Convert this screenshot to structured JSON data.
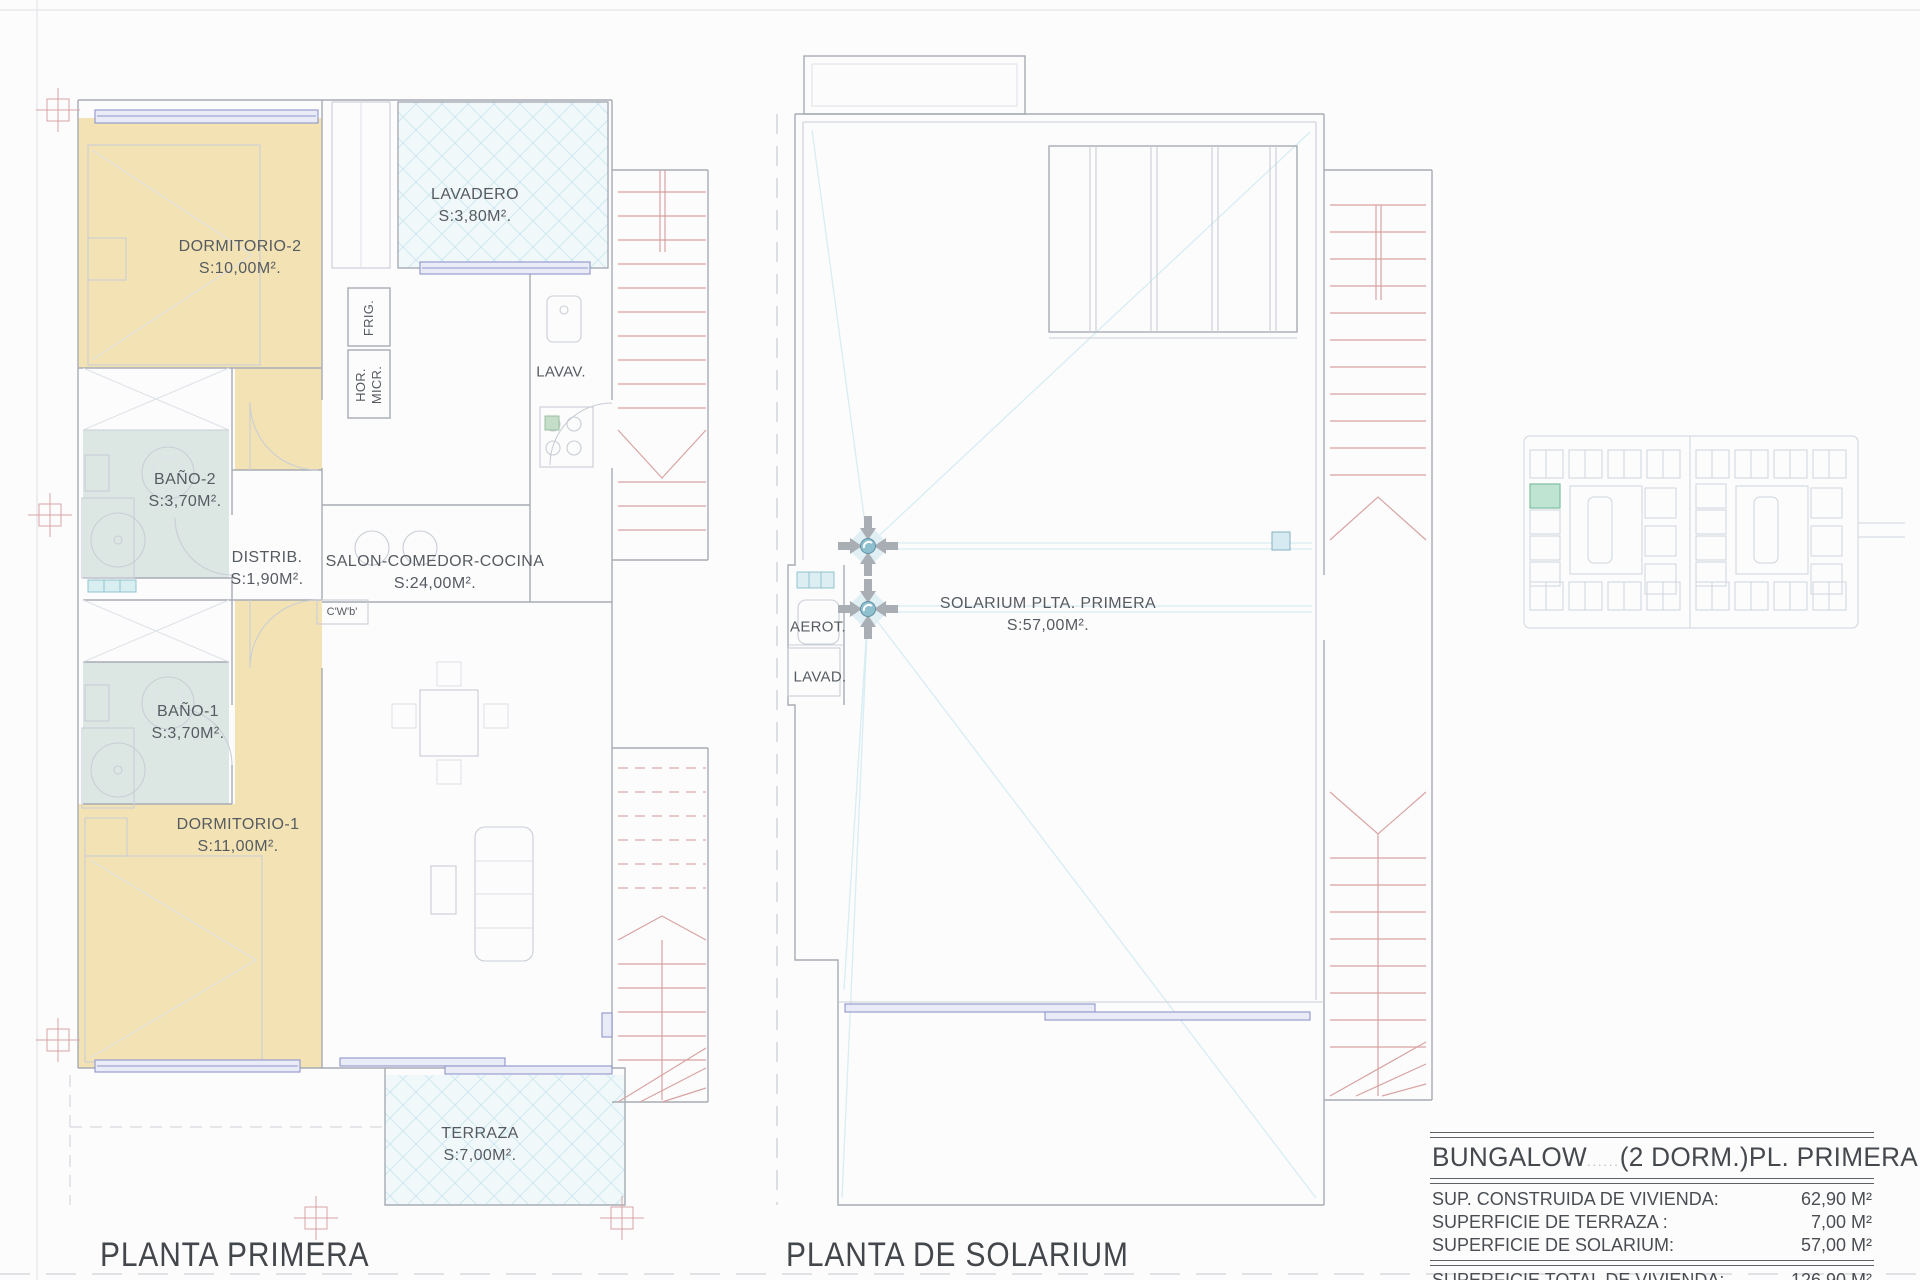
{
  "plans": {
    "primera": {
      "title": "PLANTA PRIMERA",
      "rooms": [
        {
          "name": "DORMITORIO-2",
          "area": "S:10,00M²."
        },
        {
          "name": "LAVADERO",
          "area": "S:3,80M²."
        },
        {
          "name": "BAÑO-2",
          "area": "S:3,70M²."
        },
        {
          "name": "DISTRIB.",
          "area": "S:1,90M²."
        },
        {
          "name": "SALON-COMEDOR-COCINA",
          "area": "S:24,00M²."
        },
        {
          "name": "BAÑO-1",
          "area": "S:3,70M²."
        },
        {
          "name": "DORMITORIO-1",
          "area": "S:11,00M²."
        },
        {
          "name": "TERRAZA",
          "area": "S:7,00M²."
        }
      ],
      "fixtures": {
        "frig": "FRIG.",
        "hor": "HOR.",
        "micr": "MICR.",
        "lavav": "LAVAV.",
        "cwb": "C'W'b'"
      }
    },
    "solarium": {
      "title": "PLANTA DE SOLARIUM",
      "rooms": [
        {
          "name": "SOLARIUM PLTA. PRIMERA",
          "area": "S:57,00M²."
        }
      ],
      "fixtures": {
        "aerot": "AEROT.",
        "lavad": "LAVAD."
      }
    }
  },
  "summary": {
    "model": "BUNGALOW",
    "model_gap": "......",
    "dorms": "(2 DORM.)",
    "floor": "PL. PRIMERA.",
    "rows": [
      {
        "label": "SUP. CONSTRUIDA DE VIVIENDA:",
        "value": "62,90 M²"
      },
      {
        "label": "SUPERFICIE DE TERRAZA :",
        "value": "7,00 M²"
      },
      {
        "label": "SUPERFICIE  DE SOLARIUM:",
        "value": "57,00 M²"
      }
    ],
    "total": {
      "label": "SUPERFICIE  TOTAL DE VIVIENDA:",
      "value": "126,90 M²"
    }
  },
  "colors": {
    "floor_tan": "#f3e3b4",
    "floor_bath": "#dce7e4",
    "lattice_bg": "#f1f8fa",
    "window_purple": "#8f94cb",
    "stair_red": "#d8a3a3",
    "slope_cyan": "#d7edf2",
    "highlight_green": "#c0e4d2"
  }
}
